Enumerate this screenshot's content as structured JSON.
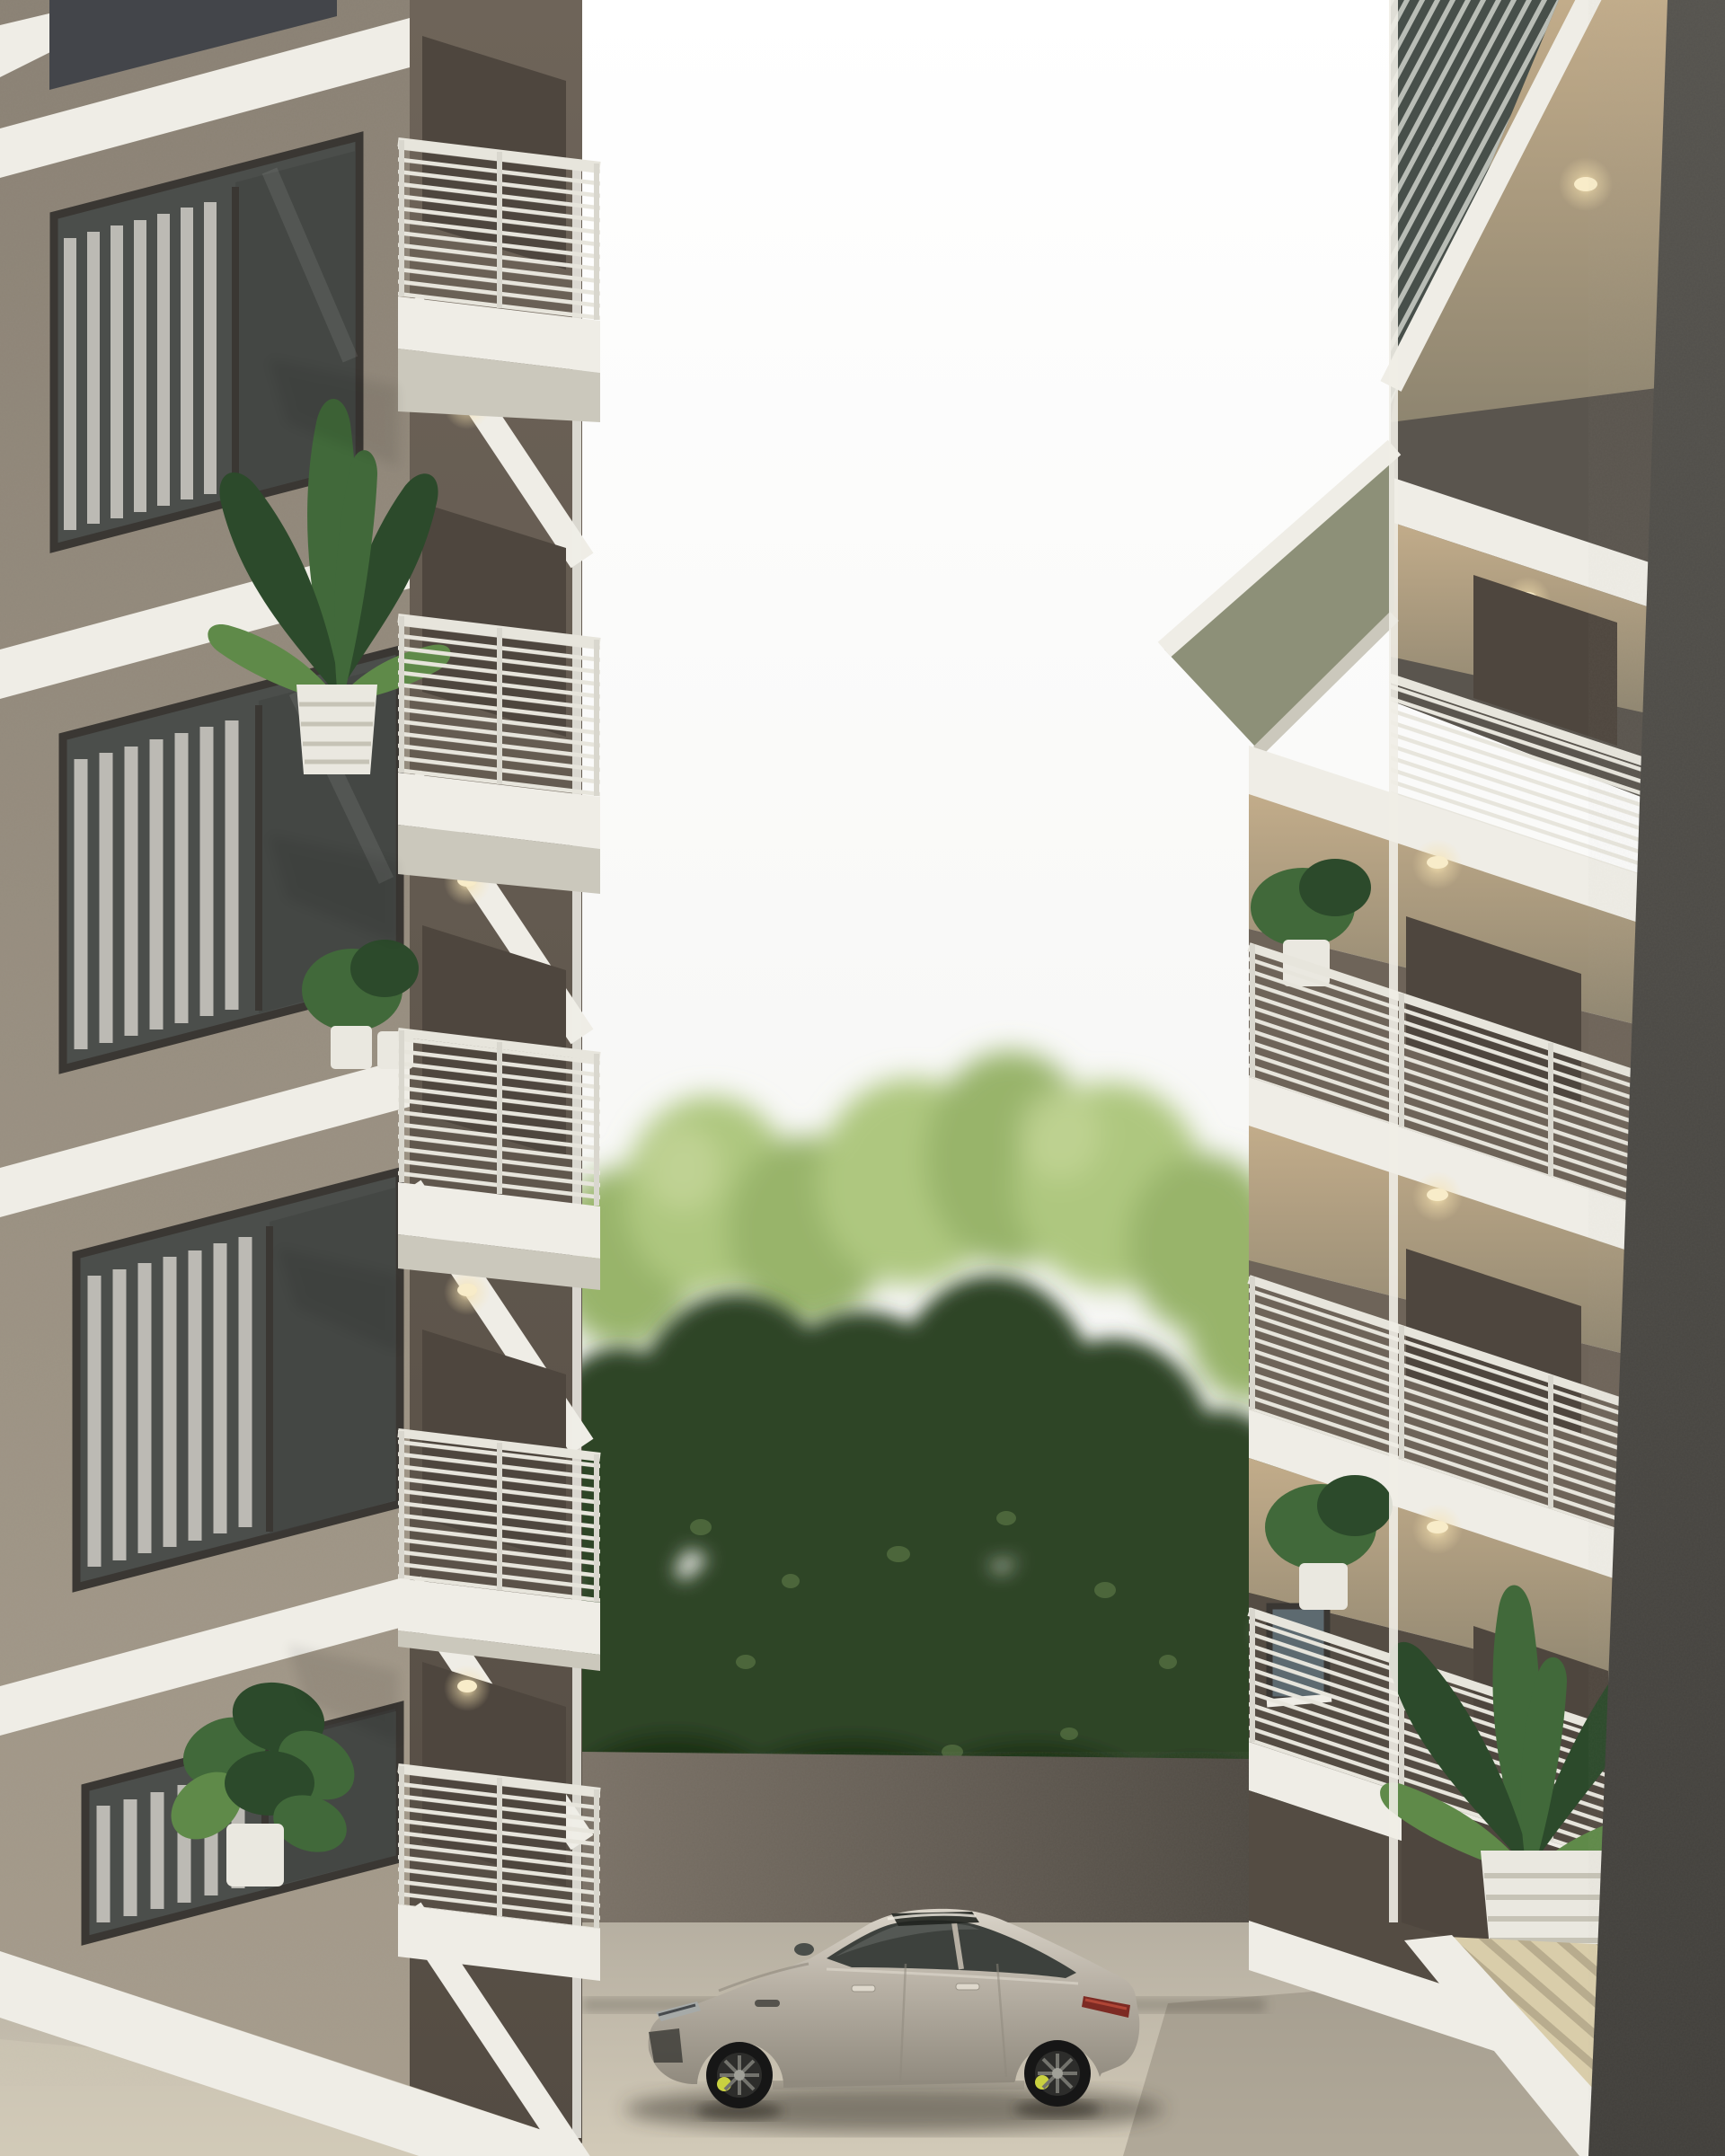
{
  "scene": {
    "type": "architectural-exterior-3d-render",
    "description": "Photorealistic daylight rendering of a residential courtyard between two modern grey stucco apartment buildings with white floor slabs, slatted metal balcony railings, recessed balconies with warm ceiling downlights and potted tropical plants; dense green trees rise above a brown courtyard wall, and a silver-beige fastback luxury sedan with black multi-spoke wheels and yellow brake calipers is parked on beige concrete paving in the centre.",
    "environment": {
      "sky": "overcast bright white sky",
      "vegetation": "tall birch-like trees, light green crowns over a dark green mass",
      "ground": "light beige concrete pavement",
      "rear_wall": "grey-brown courtyard wall below the trees"
    },
    "left_building": {
      "material": "taupe grey stucco",
      "floors_visible": 5,
      "features": [
        "white slab bands",
        "dark-framed sliding windows with white curtains",
        "five cantilevered balconies with white slatted railings",
        "warm recessed downlights",
        "banana plant in white ribbed pot",
        "monstera plant in white pot",
        "small potted plants"
      ]
    },
    "right_building": {
      "material": "grey stucco with dark concrete corner column",
      "floors_visible": 6,
      "features": [
        "recessed balconies with warm lit ceilings",
        "white slatted railings",
        "roof eave with white fascia",
        "large banana plant in white ribbed pot",
        "small balcony plants",
        "small window with white sill"
      ]
    },
    "car": {
      "style": "four-door fastback luxury coupe",
      "color": "silver-beige metallic",
      "details": [
        "panoramic sunroof",
        "dark tinted glass",
        "black multi-spoke wheels",
        "yellow brake calipers",
        "red tail lamp"
      ]
    }
  },
  "palette": {
    "sky1": "#ffffff",
    "sky2": "#f1f1ee",
    "facadeTop": "#8a8174",
    "facadeBot": "#a69c8c",
    "bayCol1": "#6e6459",
    "bayCol2": "#544c43",
    "slab": "#efede6",
    "slabShade": "#cbc8bc",
    "railC": "#e7e5dc",
    "railPost": "#d9d7ce",
    "frame": "#3a3733",
    "glassDark": "#4b4e4b",
    "glassLight": "#6f7571",
    "curtain": "#e2dfd7",
    "doorDark": "#4e463e",
    "treeLight": "#98b46a",
    "treeLight2": "#aec77f",
    "treeHi": "#c6d79b",
    "treeDark": "#2e4527",
    "treeDeep": "#1f3019",
    "treeSpeck": "#6a8850",
    "wallRearL": "#7b7267",
    "wallRearR": "#4f4a43",
    "paveLight": "#d2cab8",
    "pave": "#b6afa1",
    "paveDark": "#8f8879",
    "eaveC": "#8d9078",
    "ceilWarm1": "#c2ac8a",
    "ceilWarm2": "#8e8570",
    "glow": "#f6e2b0",
    "sideWall": "#5a554e",
    "colTop": "#55534e",
    "colBot": "#413f3b",
    "potWhite": "#eae8e0",
    "potShade": "#c6c3b6",
    "plantDark": "#2c4a2b",
    "plantMid": "#41693a",
    "plantLight": "#5f8a49",
    "carBody": "#b6afa3",
    "carHi": "#dad4c9",
    "carLo": "#8f897d",
    "carGlass": "#3d413d",
    "glassRefl": "#707672",
    "tire": "#161616",
    "rimC": "#2d2d2b",
    "spoke": "#73736d",
    "hub": "#a0a098",
    "caliper": "#c9d140",
    "lampRed": "#7d2a23",
    "lampRedHi": "#b04536",
    "shadowC": "#332f28",
    "creamSlat": "#d9cdaa",
    "creamLine": "#9c9177"
  }
}
